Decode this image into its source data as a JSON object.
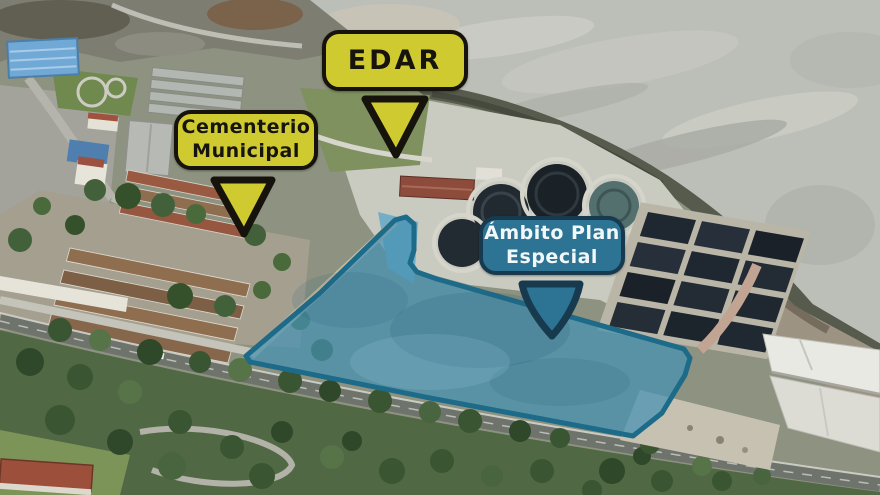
{
  "callouts": {
    "edar": {
      "label": "EDAR"
    },
    "cementerio": {
      "line1": "Cementerio",
      "line2": "Municipal"
    },
    "ambito": {
      "line1": "Ámbito Plan",
      "line2": "Especial"
    }
  },
  "colors": {
    "callout-yellow": "#d0ca31",
    "callout-dark-border": "#16130d",
    "callout-teal": "#2d7494",
    "callout-teal-border": "#173a4e",
    "callout-teal-text": "#f2f7f9",
    "zone-fill": "#4792b3",
    "zone-border": "#1d6b89"
  }
}
